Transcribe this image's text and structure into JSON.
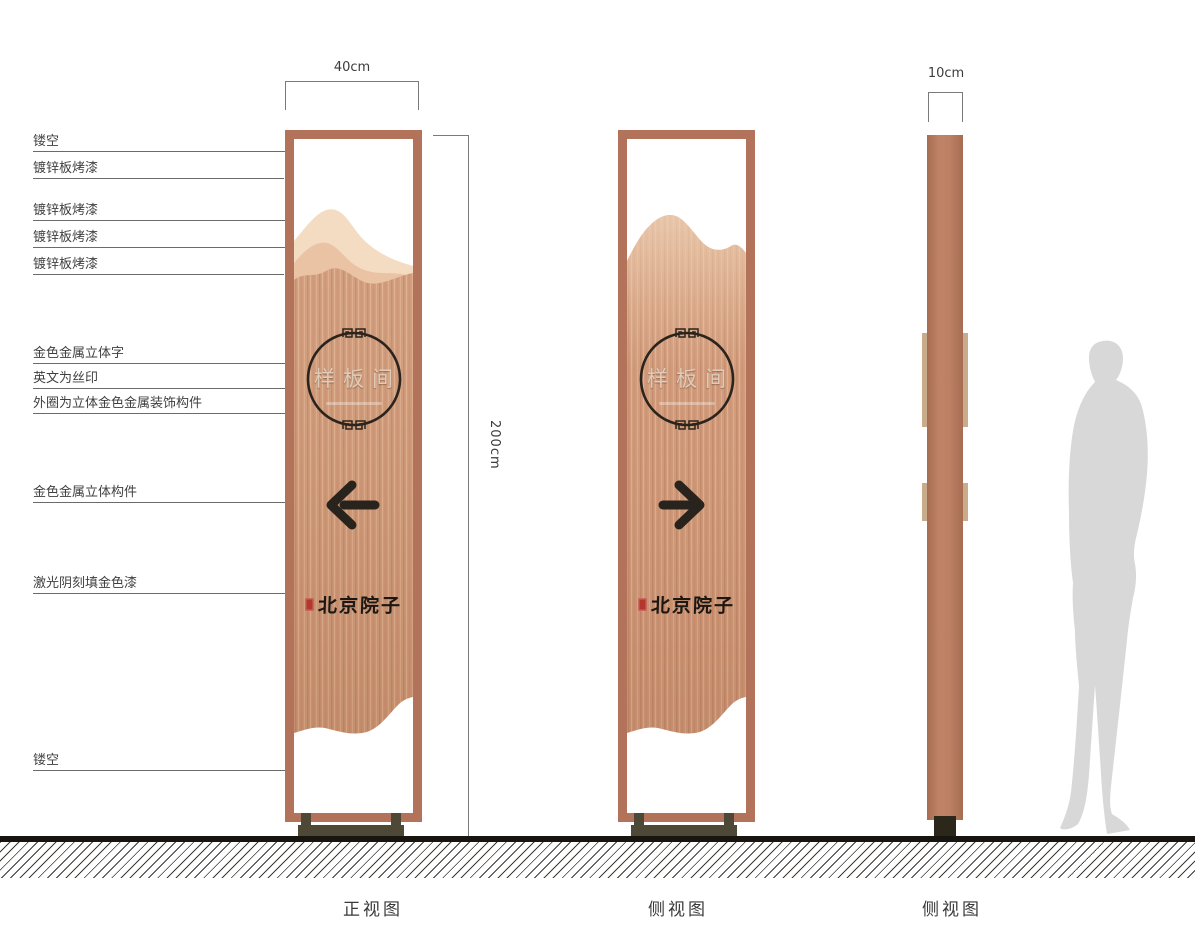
{
  "annotations": {
    "labels": [
      {
        "text": "镂空"
      },
      {
        "text": "镀锌板烤漆"
      },
      {
        "text": "镀锌板烤漆"
      },
      {
        "text": "镀锌板烤漆"
      },
      {
        "text": "镀锌板烤漆"
      },
      {
        "text": "金色金属立体字"
      },
      {
        "text": "英文为丝印"
      },
      {
        "text": "外圈为立体金色金属装饰构件"
      },
      {
        "text": "金色金属立体构件"
      },
      {
        "text": "激光阴刻填金色漆"
      },
      {
        "text": "镂空"
      }
    ]
  },
  "dimensions": {
    "front_width": "40cm",
    "total_height": "200cm",
    "side_depth": "10cm"
  },
  "views": {
    "front": {
      "caption": "正视图",
      "plate_text": "样板间",
      "brand_text": "北京院子",
      "arrow_direction": "left"
    },
    "side_a": {
      "caption": "侧视图",
      "plate_text": "样板间",
      "brand_text": "北京院子",
      "arrow_direction": "right"
    },
    "side_b": {
      "caption": "侧视图"
    }
  },
  "colors": {
    "frame_copper": "#b2735a",
    "panel_brushed_copper": "#d09a79",
    "mountain_light": "#f3dcc2",
    "mountain_mid": "#e9c3a4",
    "ornament_dark": "#2b241d",
    "seal_red": "#b4372b",
    "base_olive": "#4e4937",
    "ground_black": "#18140f",
    "silhouette_gray": "#d8d8d8"
  }
}
